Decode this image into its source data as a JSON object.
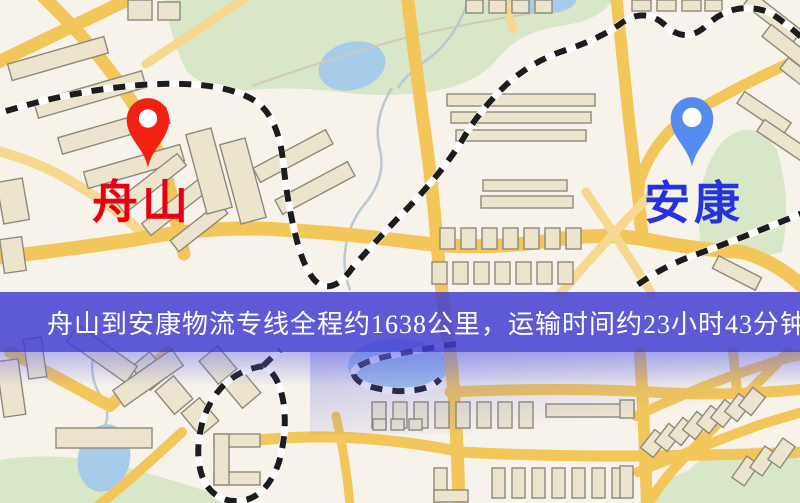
{
  "banner": {
    "text": "舟山到安康物流专线全程约1638公里，运输时间约23小时43分钟."
  },
  "markers": {
    "origin": {
      "label": "舟山",
      "label_color": "#e60012",
      "pin_color": "#f02012"
    },
    "destination": {
      "label": "安康",
      "label_color": "#2633db",
      "pin_color": "#548bef"
    }
  },
  "theme": {
    "banner_bg": "rgba(64,61,210,0.84)",
    "banner_text_color": "#ffffff",
    "road_color": "#f2c659",
    "minor_road_color": "#f6d98f",
    "rail_color": "#1c1c1c",
    "water_color": "#a6cce9",
    "park_color": "#d8e7c8",
    "building_fill": "#ece4cd",
    "building_stroke": "#8d897c",
    "map_background": "#f7f2ea"
  }
}
